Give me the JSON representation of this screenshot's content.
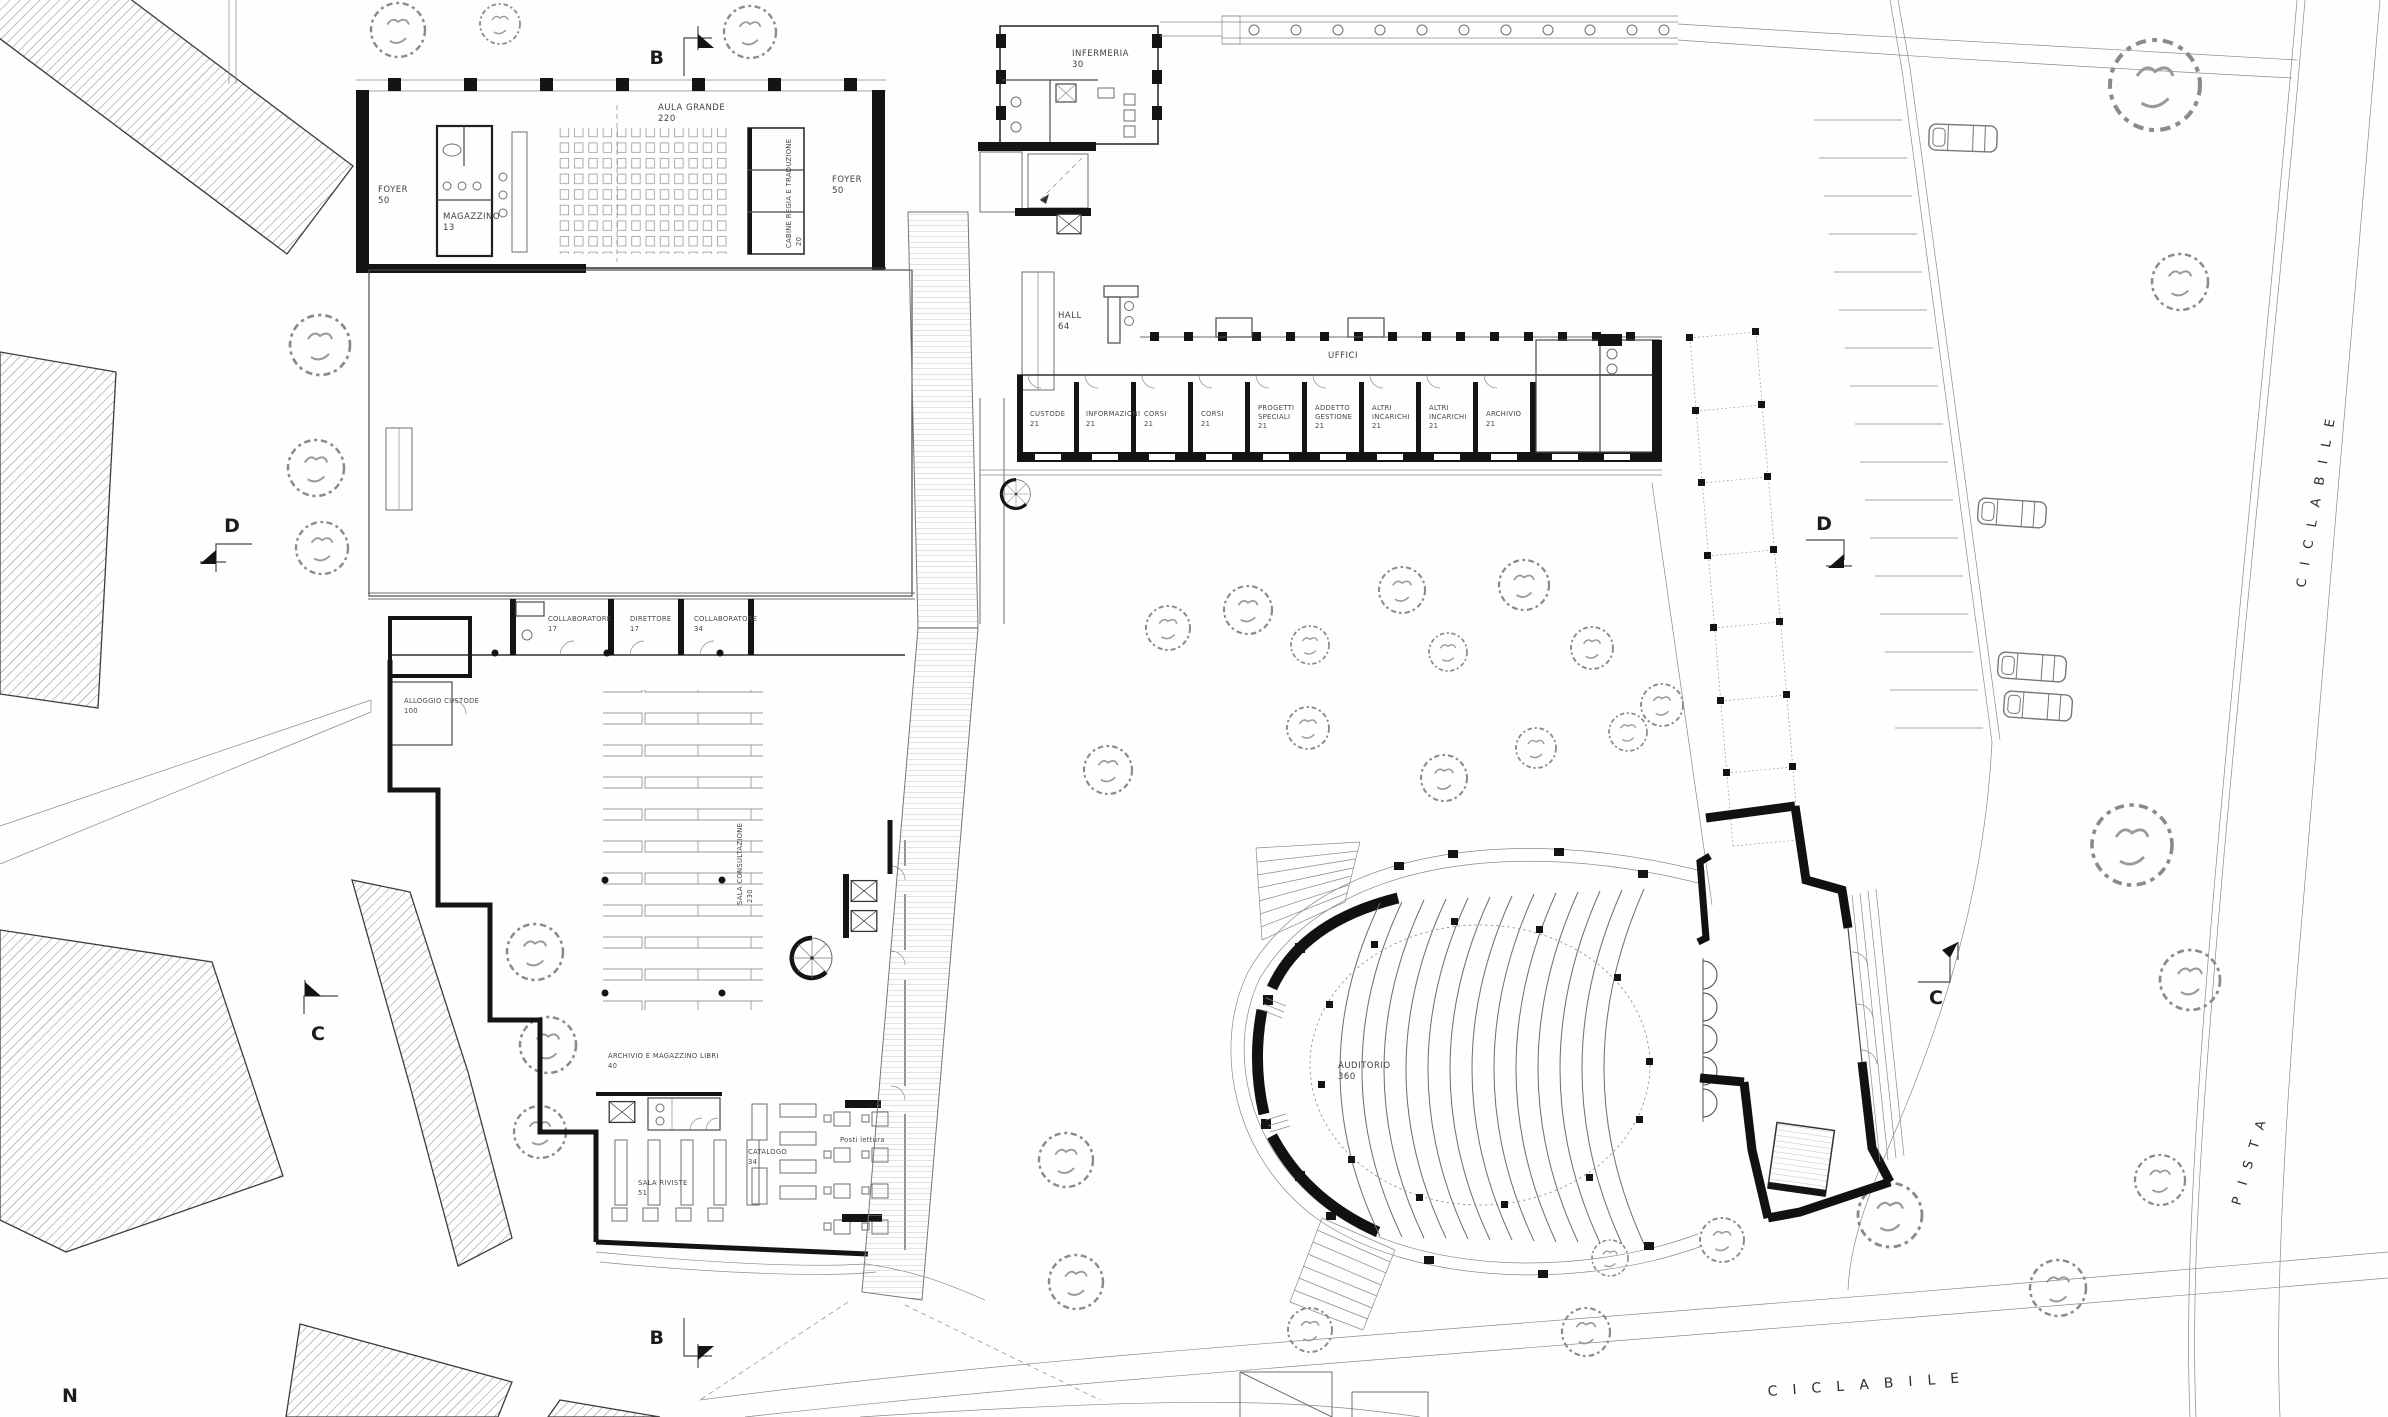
{
  "rooms": {
    "foyer_left": {
      "name": "FOYER",
      "area": "50"
    },
    "magazzino": {
      "name": "MAGAZZINO",
      "area": "13"
    },
    "aula_grande": {
      "name": "AULA GRANDE",
      "area": "220"
    },
    "cabine_regia": {
      "name": "CABINE REGIA E TRADUZIONE",
      "area": "20"
    },
    "foyer_right": {
      "name": "FOYER",
      "area": "50"
    },
    "infermeria": {
      "name": "INFERMERIA",
      "area": "30"
    },
    "hall": {
      "name": "HALL",
      "area": "64"
    },
    "alloggio_custode": {
      "name": "ALLOGGIO CUSTODE",
      "area": "100"
    },
    "sala_consultazione": {
      "name": "SALA CONSULTAZIONE",
      "area": "230"
    },
    "archivio_magazzino_libri": {
      "name": "ARCHIVIO E MAGAZZINO LIBRI",
      "area": "40"
    },
    "sala_riviste": {
      "name": "SALA RIVISTE",
      "area": "51"
    },
    "catalogo": {
      "name": "CATALOGO",
      "area": "34"
    },
    "posti_lettura": {
      "name": "Posti lettura"
    },
    "auditorio": {
      "name": "AUDITORIO",
      "area": "360"
    }
  },
  "office_wing": {
    "label": "UFFICI",
    "rooms": [
      {
        "line1": "CUSTODE",
        "line2": "",
        "area": "21"
      },
      {
        "line1": "INFORMAZIONI",
        "line2": "",
        "area": "21"
      },
      {
        "line1": "CORSI",
        "line2": "",
        "area": "21"
      },
      {
        "line1": "CORSI",
        "line2": "",
        "area": "21"
      },
      {
        "line1": "PROGETTI",
        "line2": "SPECIALI",
        "area": "21"
      },
      {
        "line1": "ADDETTO",
        "line2": "GESTIONE",
        "area": "21"
      },
      {
        "line1": "ALTRI",
        "line2": "INCARICHI",
        "area": "21"
      },
      {
        "line1": "ALTRI",
        "line2": "INCARICHI",
        "area": "21"
      },
      {
        "line1": "ARCHIVIO",
        "line2": "",
        "area": "21"
      }
    ]
  },
  "admin_rooms": [
    {
      "name": "COLLABORATORE",
      "area": "17"
    },
    {
      "name": "DIRETTORE",
      "area": "17"
    },
    {
      "name": "COLLABORATORE",
      "area": "34"
    }
  ],
  "paths": {
    "pista": "PISTA",
    "ciclabile_side": "CICLABILE",
    "ciclabile_bottom": "CICLABILE"
  },
  "section_markers": {
    "b_top": "B",
    "b_bottom": "B",
    "c_left": "C",
    "c_right": "C",
    "d_left": "D",
    "d_right": "D"
  },
  "compass": {
    "north": "N"
  }
}
